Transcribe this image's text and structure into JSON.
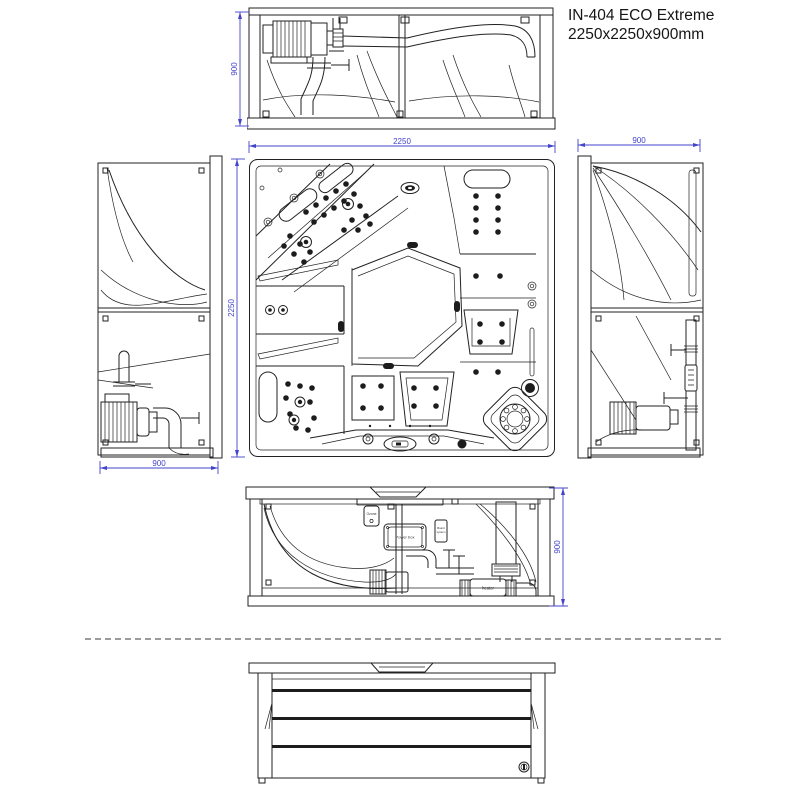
{
  "title": {
    "line1": "IN-404 ECO Extreme",
    "line2": "2250x2250x900mm"
  },
  "dimensions": {
    "top_view_height": "900",
    "plan_width": "2250",
    "plan_depth": "2250",
    "left_view_width": "900",
    "right_view_width": "900",
    "front_view_height": "900"
  },
  "equipment_labels": {
    "ozone": "Ozone",
    "power_box": "Power box",
    "board_line1": "Board",
    "board_line2": "system",
    "heater": "heater"
  },
  "colors": {
    "line": "#222222",
    "dimension": "#4343cb",
    "separator": "#9b9b9b",
    "background": "#ffffff"
  }
}
